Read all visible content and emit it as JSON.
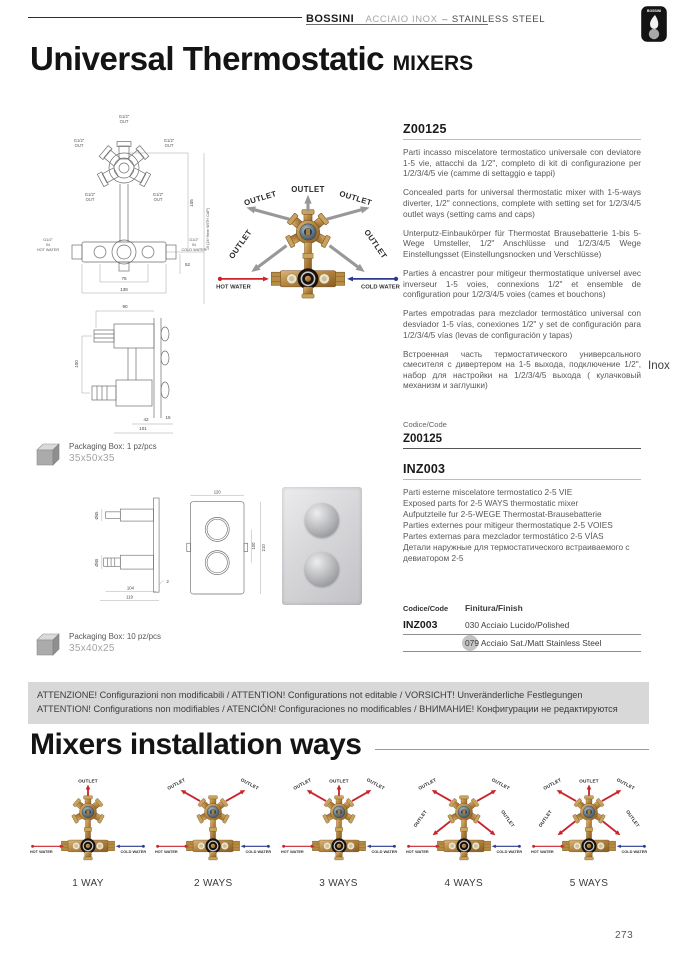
{
  "header": {
    "brand": "BOSSINI",
    "collection": "ACCIAIO INOX",
    "separator": "–",
    "collection_en": "STAINLESS STEEL",
    "logo_text": "BOSSINI"
  },
  "title": {
    "main": "Universal Thermostatic",
    "suffix": "MIXERS"
  },
  "side_label": "Inox",
  "page_number": "273",
  "diagram": {
    "outlet_label": "OUTLET",
    "hot_label": "HOT WATER",
    "cold_label": "COLD WATER"
  },
  "tech_front": {
    "thread_label": "G1/2\"",
    "out_label": "OUT",
    "in_label": "IN",
    "hot_label": "HOT WATER",
    "cold_label": "COLD WATER",
    "dim_height": "105",
    "dim_depth": "19 (24÷9mm WITH CAP)",
    "dim_inner_width": "76",
    "dim_outer_width": "138",
    "dim_offset": "52"
  },
  "tech_side": {
    "dim_top": "90",
    "dim_height": "100",
    "dim_b1": "42",
    "dim_b2": "15",
    "dim_b3": "101"
  },
  "product1": {
    "code_label": "Codice/Code",
    "code": "Z00125",
    "descriptions": [
      {
        "lang": "it",
        "text": "Parti incasso miscelatore termostatico universale con deviatore 1-5 vie, attacchi da 1/2\", completo di kit di configurazione per 1/2/3/4/5 vie (camme di settaggio e tappi)"
      },
      {
        "lang": "en",
        "text": "Concealed parts for universal thermostatic mixer with 1-5-ways diverter, 1/2\" connections, complete with setting set for 1/2/3/4/5 outlet ways (setting cams and caps)"
      },
      {
        "lang": "de",
        "text": "Unterputz-Einbaukörper für Thermostat Brausebatterie 1-bis 5-Wege Umsteller, 1/2\" Anschlüsse und 1/2/3/4/5 Wege Einstellungsset (Einstellungsnocken und Verschlüsse)"
      },
      {
        "lang": "fr",
        "text": "Parties à encastrer pour mitigeur thermostatique universel avec inverseur 1-5 voies, connexions 1/2\" et ensemble de configuration pour 1/2/3/4/5 voies (cames et bouchons)"
      },
      {
        "lang": "es",
        "text": "Partes empotradas para mezclador termostático universal con desviador 1-5 vías, conexiones 1/2\" y set de configuración para 1/2/3/4/5 vías (levas de configuración y tapas)"
      },
      {
        "lang": "ru",
        "text": "Встроенная часть термостатического универсального смесителя с дивертером на 1-5 выхода, подключение 1/2\", набор для настройки на 1/2/3/4/5 выхода ( кулачковый механизм и заглушки)"
      }
    ],
    "packaging_label": "Packaging Box: 1 pz/pcs",
    "packaging_size": "35x50x35"
  },
  "product2": {
    "code": "INZ003",
    "descriptions": [
      {
        "lang": "it",
        "text": "Parti esterne miscelatore termostatico 2-5 VIE"
      },
      {
        "lang": "en",
        "text": "Exposed parts for 2-5 WAYS thermostatic mixer"
      },
      {
        "lang": "de",
        "text": "Aufputzteile fur 2-5-WEGE Thermostat-Brausebatterie"
      },
      {
        "lang": "fr",
        "text": "Parties externes pour mitigeur thermostatique 2-5 VOIES"
      },
      {
        "lang": "es",
        "text": "Partes externas para mezclador termostático 2-5 VÍAS"
      },
      {
        "lang": "ru",
        "text": "Детали наружные для термостатического встраиваемого с девиатором 2-5"
      }
    ],
    "packaging_label": "Packaging Box: 10 pz/pcs",
    "packaging_size": "35x40x25",
    "finish_table": {
      "code_header": "Codice/Code",
      "finish_header": "Finitura/Finish",
      "rows": [
        {
          "code": "INZ003",
          "finish": "030 Acciaio Lucido/Polished",
          "highlighted": false
        },
        {
          "code": "",
          "finish": "079 Acciaio Sat./Matt Stainless Steel",
          "highlighted": true
        }
      ]
    }
  },
  "inz_drawing": {
    "dim_width": "120",
    "dim_centers": "100",
    "dim_height": "210",
    "dim_d1": "Ø45",
    "dim_d2": "Ø45",
    "dim_plate": "2",
    "dim_b1": "104",
    "dim_b2": "119"
  },
  "attention": {
    "line1": "ATTENZIONE! Configurazioni non modificabili / ATTENTION! Configurations not editable / VORSICHT! Unveränderliche Festlegungen",
    "line2": "ATTENTION! Configurations non modifiables / ATENCIÓN! Configuraciones no modificables / ВНИМАНИЕ! Конфигурации не редактируются"
  },
  "installation": {
    "title": "Mixers installation ways",
    "outlet_label": "OUTLET",
    "hot_label": "HOT WATER",
    "cold_label": "COLD WATER",
    "ways": [
      {
        "label": "1 WAY",
        "arrows": [
          "top"
        ]
      },
      {
        "label": "2 WAYS",
        "arrows": [
          "upper-left",
          "upper-right"
        ]
      },
      {
        "label": "3 WAYS",
        "arrows": [
          "top",
          "upper-left",
          "upper-right"
        ]
      },
      {
        "label": "4 WAYS",
        "arrows": [
          "upper-left",
          "upper-right",
          "lower-left",
          "lower-right"
        ]
      },
      {
        "label": "5 WAYS",
        "arrows": [
          "top",
          "upper-left",
          "upper-right",
          "lower-left",
          "lower-right"
        ]
      }
    ]
  },
  "colors": {
    "accent_red": "#c9242b",
    "accent_blue": "#2b3a8f",
    "arrow_gray": "#98989a",
    "brass": "#b5843f",
    "banner_bg": "#d8d8d8"
  }
}
